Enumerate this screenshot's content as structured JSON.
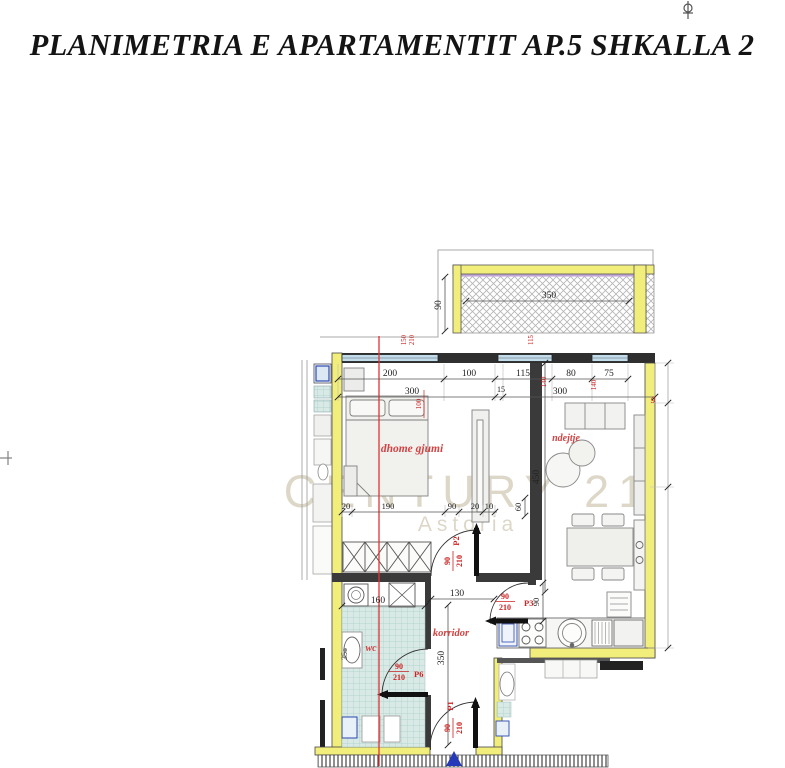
{
  "title": "PLANIMETRIA E APARTAMENTIT AP.5 SHKALLA 2",
  "watermark": {
    "l1": "CENTURY 21",
    "l2": "Astoria"
  },
  "rooms": {
    "bedroom": "dhome gjumi",
    "living": "ndejtje",
    "wc": "wc",
    "corridor": "korridor",
    "partial": "g"
  },
  "doors": {
    "p1": {
      "id": "P1",
      "w": "90",
      "h": "210"
    },
    "p2": {
      "id": "P2",
      "w": "90",
      "h": "210"
    },
    "p3": {
      "id": "P3",
      "w": "90",
      "h": "210"
    },
    "p6": {
      "id": "P6",
      "w": "90",
      "h": "210"
    }
  },
  "dims": {
    "row1": [
      "200",
      "100",
      "115",
      "80",
      "75"
    ],
    "row2": [
      "300",
      "15",
      "300"
    ],
    "balcony_width": "350",
    "balcony_depth": "90",
    "bedroom_row": [
      "20",
      "190",
      "90",
      "20",
      "10"
    ],
    "living_depth": "450",
    "niche": "60",
    "kitchen_door": "90",
    "corridor_width": "130",
    "wc_width": "160",
    "corridor_depth": "350",
    "wc_fixture": "35",
    "window_marks": [
      "150",
      "210",
      "100",
      "115",
      "140",
      "140"
    ]
  },
  "colors": {
    "wall_yellow": "#f2ee7c",
    "window_blue": "#c3dcea",
    "annotation_red": "#cc2222",
    "room_red": "#d04343",
    "tile_teal": "#d9e9e5",
    "watermark_tan": "#d8d1bf",
    "balcony_purple": "#c3a6d8",
    "entry_blue": "#2438b8",
    "section_red": "#e03333"
  }
}
